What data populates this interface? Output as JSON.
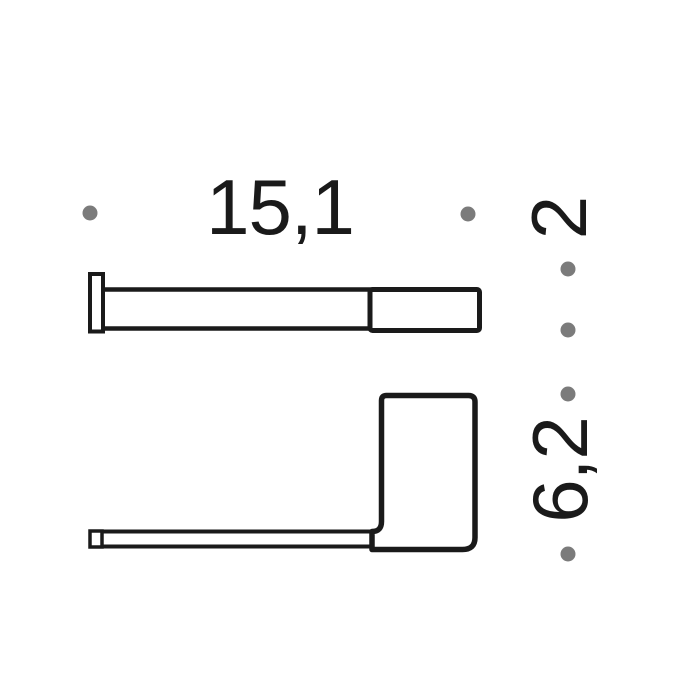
{
  "dimensions": {
    "width": {
      "label": "15,1"
    },
    "depth": {
      "label": "2"
    },
    "height": {
      "label": "6,2"
    }
  },
  "colors": {
    "line": "#1a1a1a",
    "dot": "#7b7b7b",
    "text": "#1a1a1a",
    "background": "#ffffff"
  }
}
